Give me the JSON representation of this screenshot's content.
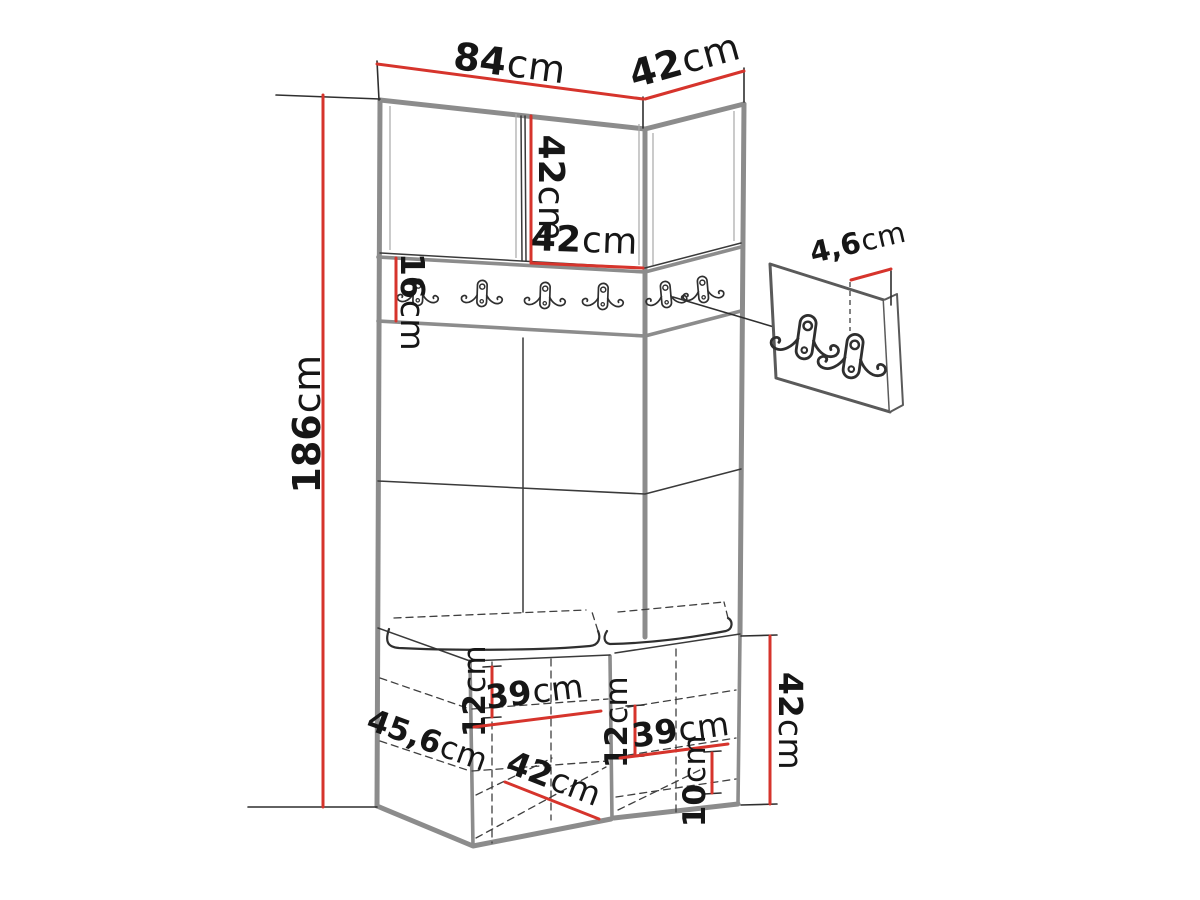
{
  "diagram": {
    "type": "furniture-technical-drawing",
    "subject": "corner hallway wardrobe with coat hook rail, upholstered wall panels, shoe bench and separate wall hook panel",
    "dimensions": {
      "top_width": {
        "num": "84",
        "unit": "cm"
      },
      "top_depth": {
        "num": "42",
        "unit": "cm"
      },
      "upper_cabinet_height": {
        "num": "42",
        "unit": "cm"
      },
      "upper_cabinet_door_width": {
        "num": "42",
        "unit": "cm"
      },
      "hook_rail_height": {
        "num": "16",
        "unit": "cm"
      },
      "total_height": {
        "num": "186",
        "unit": "cm"
      },
      "hook_panel_thickness": {
        "num": "4,6",
        "unit": "cm"
      },
      "bench_left_compartment_height": {
        "num": "12",
        "unit": "cm"
      },
      "bench_left_compartment_width": {
        "num": "39",
        "unit": "cm"
      },
      "bench_right_compartment_height": {
        "num": "12",
        "unit": "cm"
      },
      "bench_right_compartment_width": {
        "num": "39",
        "unit": "cm"
      },
      "bench_depth": {
        "num": "45,6",
        "unit": "cm"
      },
      "bench_bottom_width": {
        "num": "42",
        "unit": "cm"
      },
      "bench_bottom_clearance": {
        "num": "10",
        "unit": "cm"
      },
      "bench_height": {
        "num": "42",
        "unit": "cm"
      }
    },
    "hooks": {
      "rail_hook_count": 6,
      "wall_panel_hook_count": 2,
      "hook_style": "double-coat-hook"
    },
    "colors": {
      "dimension_red": "#d6342c",
      "sketch_dark": "#3a3a3a",
      "structure_gray": "#8c8c8c",
      "background": "#ffffff"
    }
  }
}
